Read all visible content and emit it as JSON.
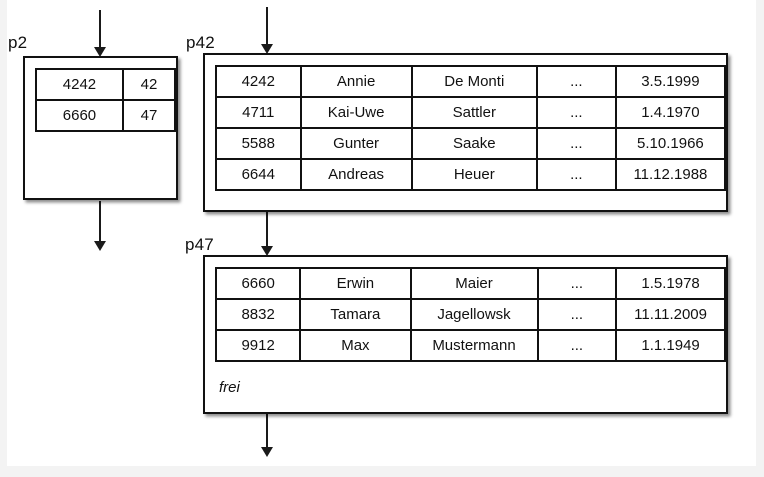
{
  "colors": {
    "ink": "#111111",
    "paper": "#ffffff",
    "page_edge": "#f3f3f3"
  },
  "p2": {
    "label": "p2",
    "rows": [
      [
        "4242",
        "42"
      ],
      [
        "6660",
        "47"
      ]
    ]
  },
  "p42": {
    "label": "p42",
    "rows": [
      [
        "4242",
        "Annie",
        "De Monti",
        "...",
        "3.5.1999"
      ],
      [
        "4711",
        "Kai-Uwe",
        "Sattler",
        "...",
        "1.4.1970"
      ],
      [
        "5588",
        "Gunter",
        "Saake",
        "...",
        "5.10.1966"
      ],
      [
        "6644",
        "Andreas",
        "Heuer",
        "...",
        "11.12.1988"
      ]
    ]
  },
  "p47": {
    "label": "p47",
    "rows": [
      [
        "6660",
        "Erwin",
        "Maier",
        "...",
        "1.5.1978"
      ],
      [
        "8832",
        "Tamara",
        "Jagellowsk",
        "...",
        "11.11.2009"
      ],
      [
        "9912",
        "Max",
        "Mustermann",
        "...",
        "1.1.1949"
      ]
    ],
    "free_label": "frei"
  }
}
